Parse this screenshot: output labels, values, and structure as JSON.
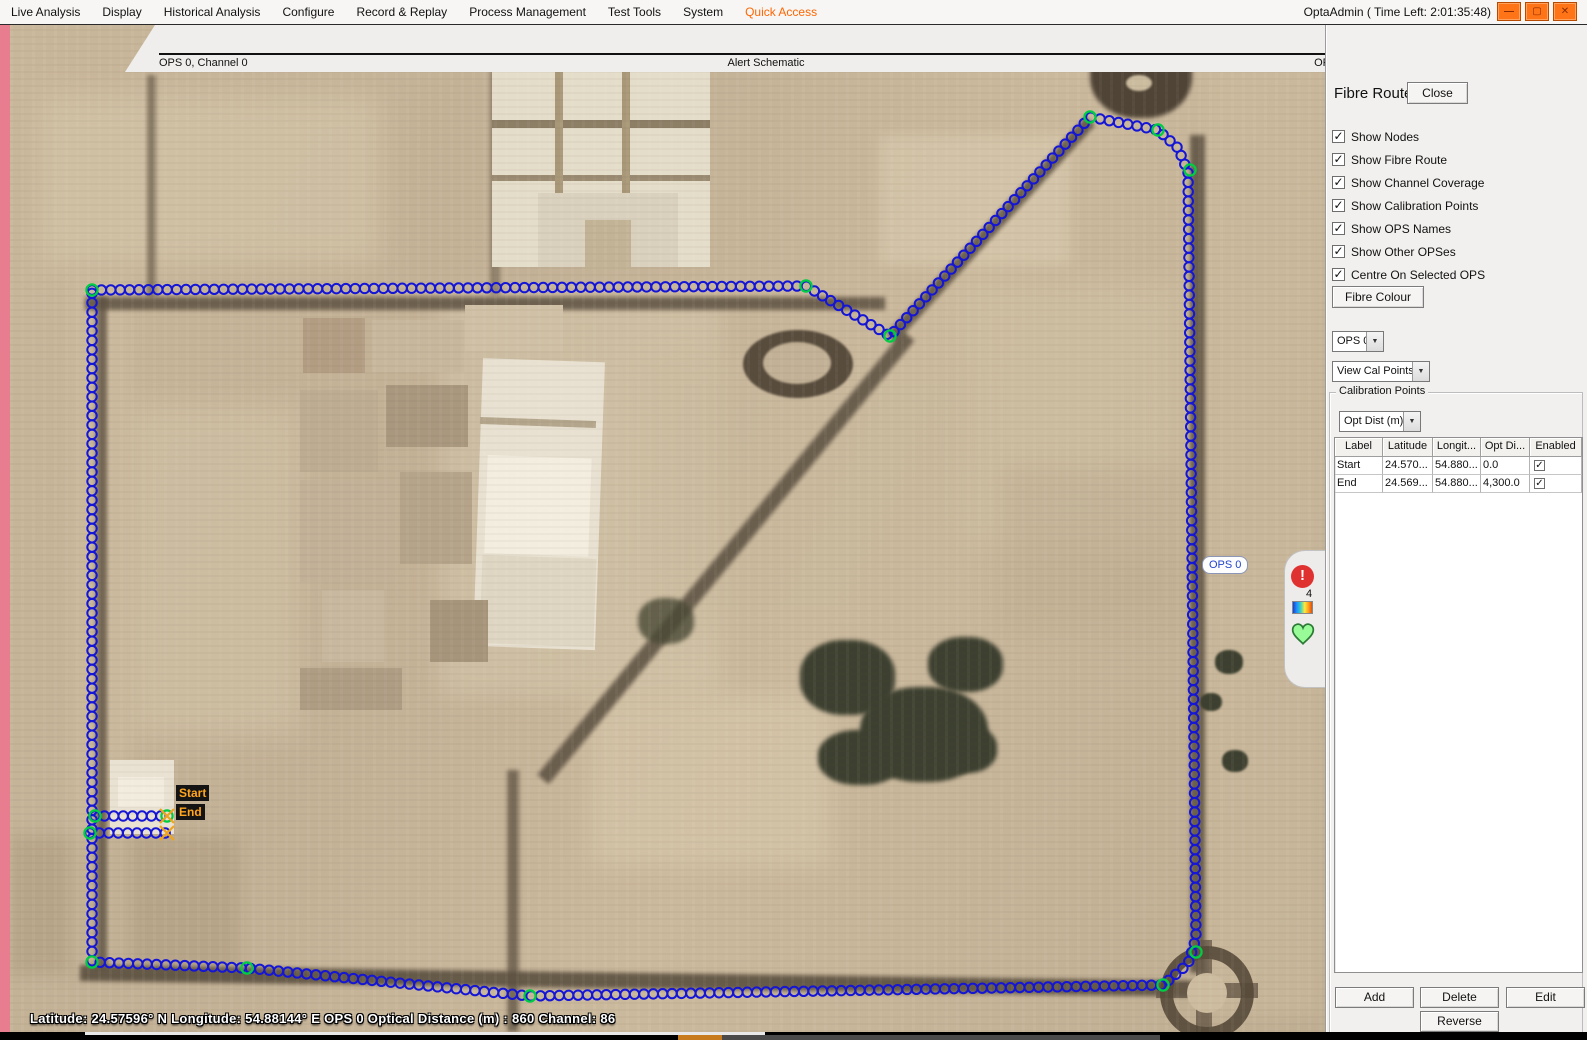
{
  "menu": {
    "items": [
      "Live Analysis",
      "Display",
      "Historical Analysis",
      "Configure",
      "Record & Replay",
      "Process Management",
      "Test Tools",
      "System",
      "Quick Access"
    ],
    "accent_item": "Quick Access",
    "accent_color": "#ff6600",
    "title": "OptaAdmin ( Time Left: 2:01:35:48)",
    "window_buttons": {
      "minimize": "—",
      "maximize": "▢",
      "close": "✕"
    }
  },
  "schematic": {
    "left_label": "OPS 0, Channel 0",
    "center_label": "Alert Schematic",
    "right_label": "OPS 0, Channel 430"
  },
  "map": {
    "ops_label": "OPS 0",
    "start_label": "Start",
    "end_label": "End",
    "status": "Latitude: 24.57596° N   Longitude: 54.88144° E  OPS 0 Optical Distance (m) : 860 Channel: 86",
    "alert_count": "4"
  },
  "route": {
    "node_color": "#1515d6",
    "cal_color": "#00cc44",
    "marker_color": "#f0a41e",
    "spacing": 9.4,
    "paths": [
      [
        [
          92,
          290
        ],
        [
          806,
          286
        ],
        [
          890,
          336
        ],
        [
          1090,
          117
        ],
        [
          1158,
          130
        ],
        [
          1178,
          148
        ],
        [
          1188,
          172
        ],
        [
          1196,
          938
        ],
        [
          1188,
          964
        ],
        [
          1163,
          985
        ],
        [
          820,
          991
        ],
        [
          530,
          996
        ],
        [
          247,
          968
        ],
        [
          92,
          962
        ],
        [
          92,
          290
        ]
      ],
      [
        [
          95,
          816
        ],
        [
          166,
          816
        ]
      ],
      [
        [
          90,
          833
        ],
        [
          166,
          833
        ]
      ]
    ],
    "cal_points": [
      [
        92,
        290
      ],
      [
        806,
        286
      ],
      [
        890,
        336
      ],
      [
        1090,
        117
      ],
      [
        1158,
        130
      ],
      [
        1190,
        170
      ],
      [
        92,
        962
      ],
      [
        247,
        968
      ],
      [
        530,
        996
      ],
      [
        1163,
        985
      ],
      [
        1196,
        952
      ],
      [
        95,
        816
      ],
      [
        167,
        816
      ],
      [
        90,
        833
      ]
    ],
    "x_markers": [
      [
        167,
        816
      ],
      [
        167,
        833
      ]
    ]
  },
  "panel": {
    "title": "Fibre Route",
    "close_label": "Close",
    "checkboxes": [
      {
        "label": "Show Nodes",
        "checked": true
      },
      {
        "label": "Show Fibre Route",
        "checked": true
      },
      {
        "label": "Show Channel Coverage",
        "checked": true
      },
      {
        "label": "Show Calibration Points",
        "checked": true
      },
      {
        "label": "Show OPS Names",
        "checked": true
      },
      {
        "label": "Show Other OPSes",
        "checked": true
      },
      {
        "label": "Centre On Selected OPS",
        "checked": true
      }
    ],
    "fibre_colour_label": "Fibre Colour",
    "ops_select": "OPS 0",
    "view_select": "View Cal Points",
    "group_title": "Calibration Points",
    "dist_select": "Opt Dist (m)",
    "table": {
      "headers": [
        "Label",
        "Latitude",
        "Longit...",
        "Opt Di...",
        "Enabled"
      ],
      "col_widths": [
        48,
        50,
        48,
        49,
        52
      ],
      "rows": [
        {
          "cells": [
            "Start",
            "24.570...",
            "54.880...",
            "0.0"
          ],
          "enabled": true
        },
        {
          "cells": [
            "End",
            "24.569...",
            "54.880...",
            "4,300.0"
          ],
          "enabled": true
        }
      ]
    },
    "buttons": {
      "add": "Add",
      "delete": "Delete",
      "edit": "Edit",
      "reverse": "Reverse"
    }
  },
  "icons": {
    "dropdown_arrow": "▼",
    "checkmark": "✓",
    "alert": "!"
  }
}
